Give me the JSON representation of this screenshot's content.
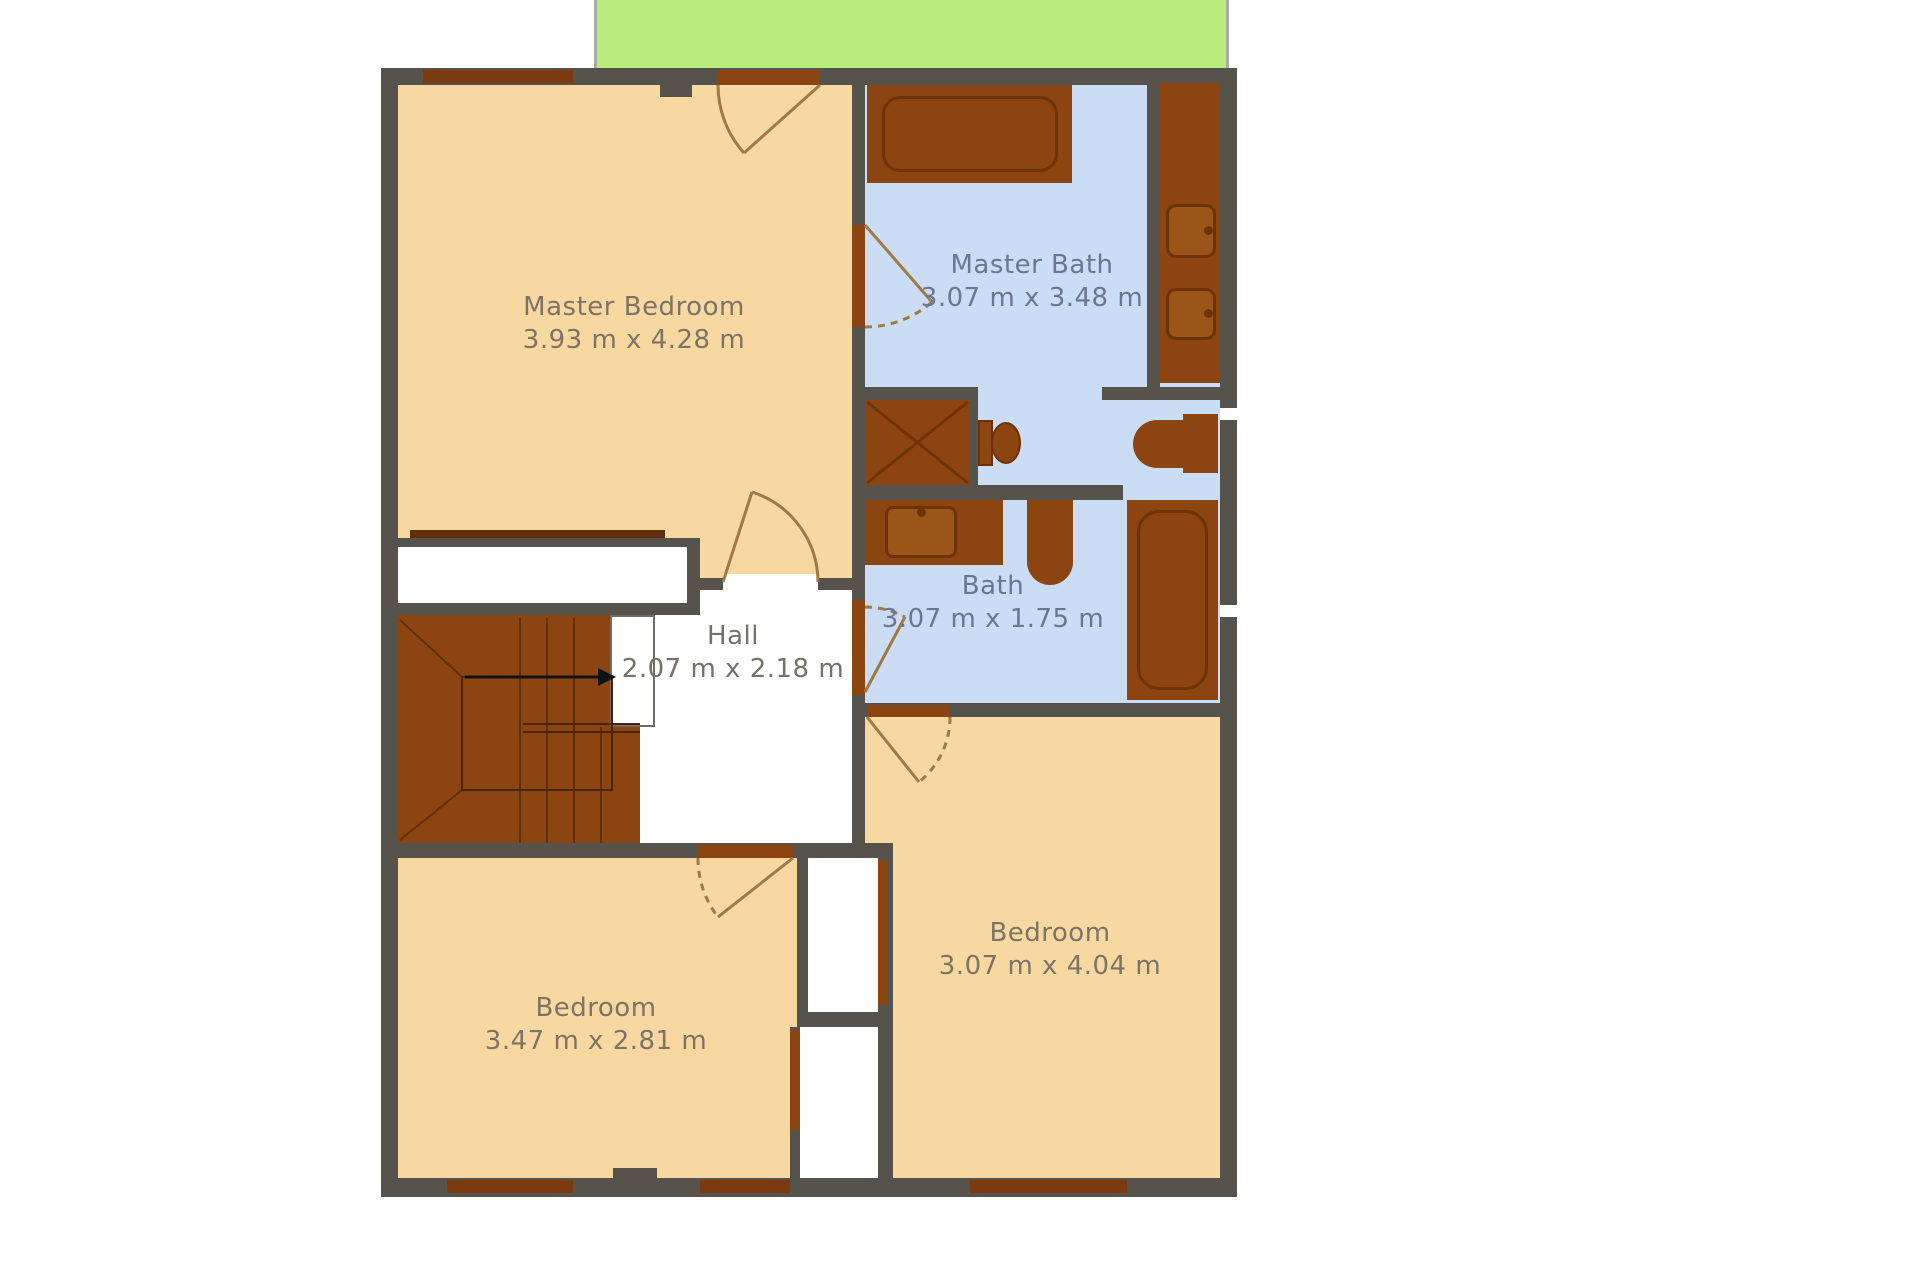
{
  "plan": {
    "type": "floor-plan",
    "rooms": [
      {
        "id": "master-bedroom",
        "name": "Master Bedroom",
        "dimensions": "3.93 m x 4.28 m",
        "floor": "wood-beige"
      },
      {
        "id": "master-bath",
        "name": "Master Bath",
        "dimensions": "3.07 m x 3.48 m",
        "floor": "tile-blue"
      },
      {
        "id": "bath",
        "name": "Bath",
        "dimensions": "3.07 m x 1.75 m",
        "floor": "tile-blue"
      },
      {
        "id": "hall",
        "name": "Hall",
        "dimensions": "2.07 m x 2.18 m",
        "floor": "white"
      },
      {
        "id": "bedroom-left",
        "name": "Bedroom",
        "dimensions": "3.47 m x 2.81 m",
        "floor": "wood-beige"
      },
      {
        "id": "bedroom-right",
        "name": "Bedroom",
        "dimensions": "3.07 m x 4.04 m",
        "floor": "wood-beige"
      }
    ],
    "features": [
      "terrace-green",
      "staircase",
      "closets",
      "bathtub",
      "shower",
      "toilets",
      "sinks"
    ],
    "colors": {
      "wall": "#56534c",
      "floor_bedroom": "#f8d8a1",
      "floor_bathroom": "#cbdcf5",
      "fixture_wood": "#8c4511",
      "fixture_outline": "#6d3307",
      "terrace_green": "#b8ec7d",
      "label_warm": "#7d7466",
      "label_blue": "#6b7693",
      "door_arc": "#a07944",
      "stair_arrow": "#111111"
    }
  }
}
